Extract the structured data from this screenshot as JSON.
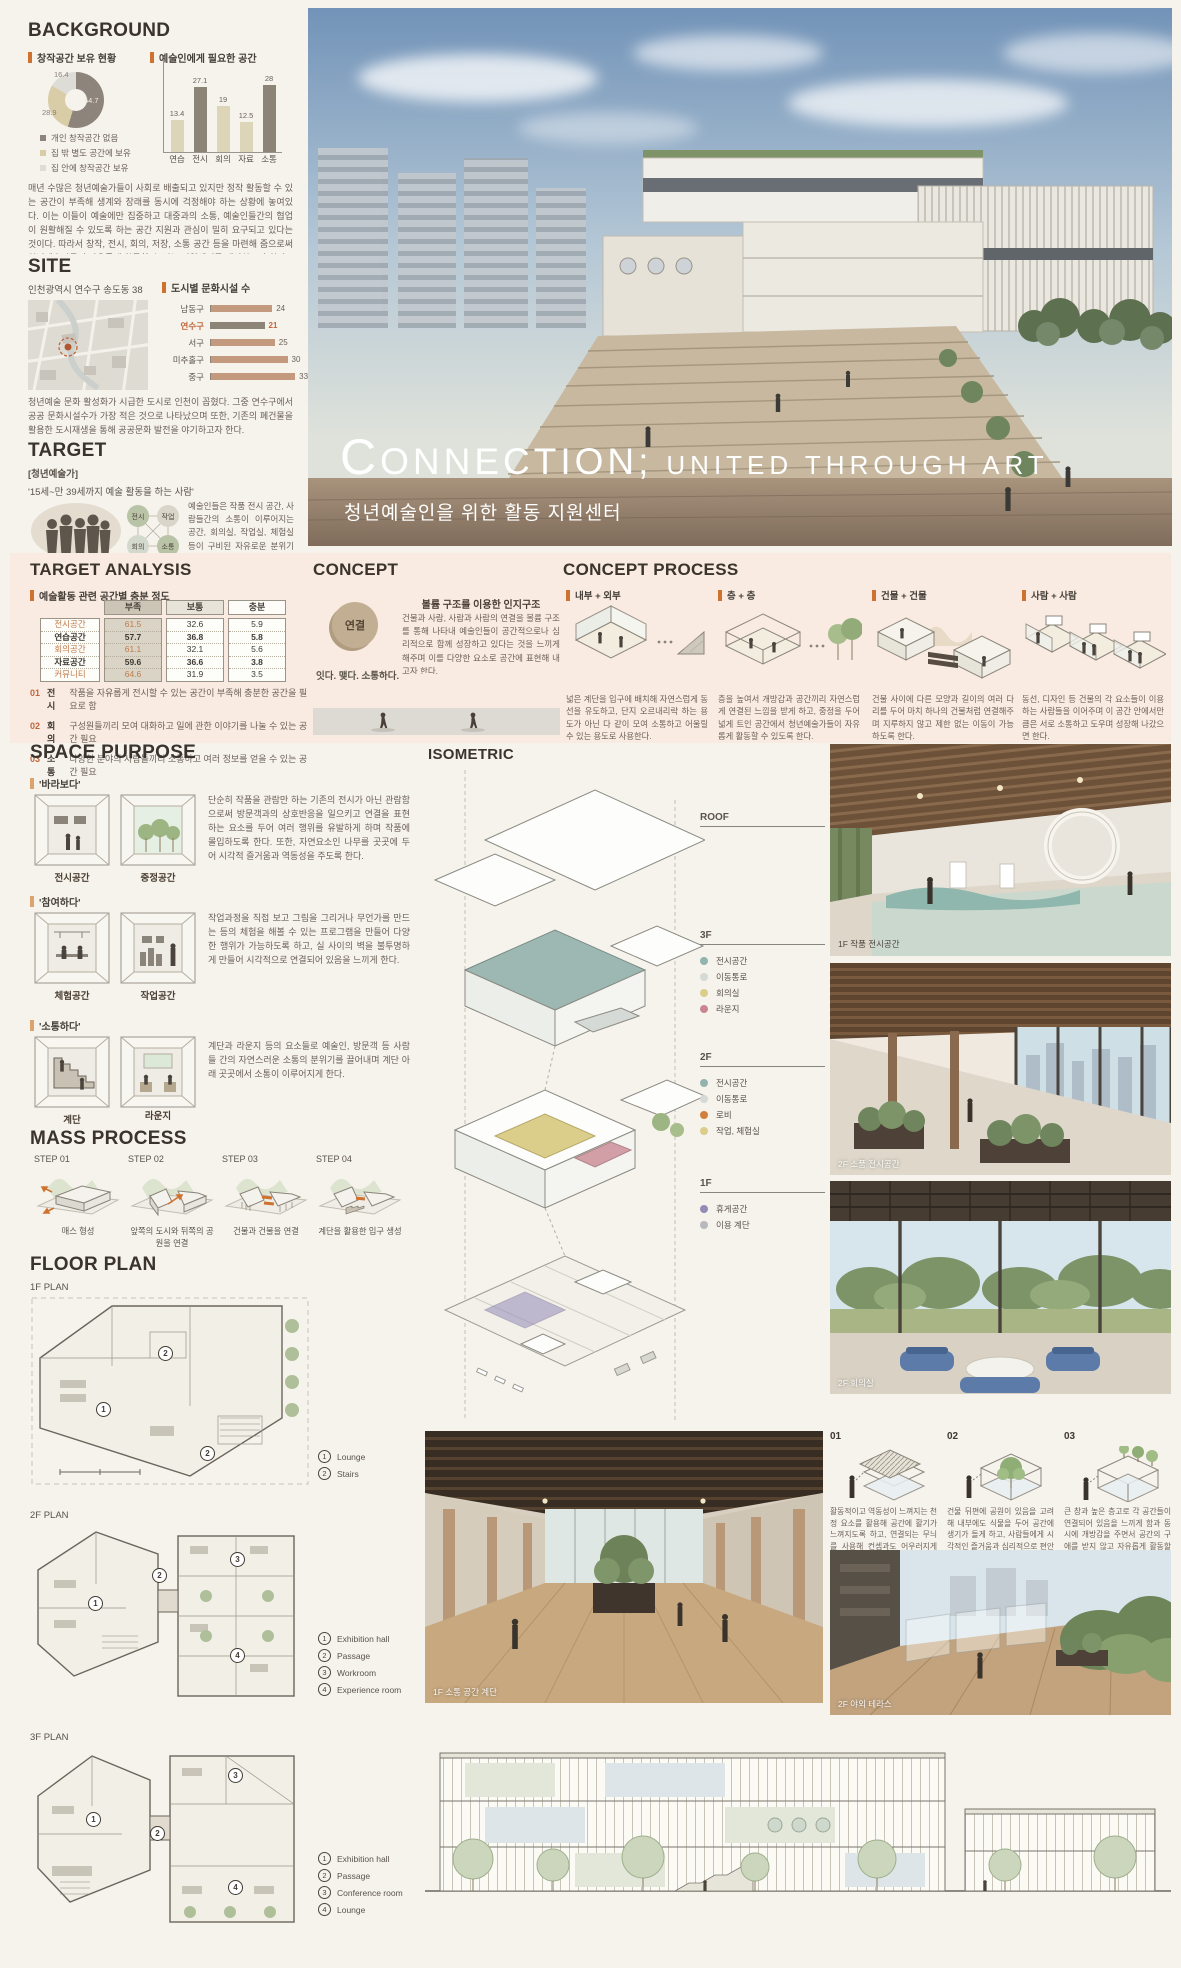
{
  "hero": {
    "title_initial": "C",
    "title_main": "ONNECTION;",
    "title_rest": "UNITED THROUGH ART",
    "subtitle": "청년예술인을 위한 활동 지원센터"
  },
  "background": {
    "heading": "BACKGROUND",
    "pie_label": "창작공간 보유 현황",
    "pie": {
      "type": "pie",
      "values": [
        54.7,
        28.9,
        16.4
      ],
      "labels": [
        "개인 창작공간 없음",
        "집 밖 별도 공간에 보유",
        "집 안에 창작공간 보유"
      ],
      "colors": [
        "#8d857b",
        "#d8cda6",
        "#dddcd7"
      ]
    },
    "bar_label": "예술인에게 필요한 공간",
    "bar": {
      "type": "bar",
      "categories": [
        "연습",
        "전시",
        "회의",
        "자료",
        "소통"
      ],
      "values": [
        13.4,
        27.1,
        19,
        12.5,
        28
      ],
      "colors": [
        "#ddd5b8",
        "#8d8478",
        "#ddd5b8",
        "#ddd5b8",
        "#8d8478"
      ]
    },
    "paragraph": "매년 수많은 청년예술가들이 사회로 배출되고 있지만 정작 활동할 수 있는 공간이 부족해 생계와 장래를 동시에 걱정해야 하는 상황에 놓여있다. 이는 이들이 예술에만 집중하고 대중과의 소통, 예술인들간의 협업이 원활해질 수 있도록 하는 공간 지원과 관심이 밀히 요구되고 있다는 것이다. 따라서 창작, 전시, 회의, 저장, 소통 공간 등을 마련해 줌으로써 청년예술가들이 자유롭게 활동할 수 있는 지원센터를 제안하고자 한다."
  },
  "site": {
    "heading": "SITE",
    "address": "인천광역시 연수구 송도동 38",
    "chart_label": "도시별 문화시설 수",
    "chart": {
      "type": "bar",
      "categories": [
        "남동구",
        "연수구",
        "서구",
        "미추홀구",
        "중구"
      ],
      "values": [
        24,
        21,
        25,
        30,
        33
      ],
      "highlight_index": 1,
      "bar_color": "#c49a7e",
      "highlight_color": "#8d8478"
    },
    "paragraph": "청년예술 문화 활성화가 시급한 도시로 인천이 꼽혔다. 그중 연수구에서 공공 문화시설수가 가장 적은 것으로 나타났으며 또한, 기존의 폐건물을 활용한 도시재생을 통해 공공문화 발전을 야기하고자 한다."
  },
  "target": {
    "heading": "TARGET",
    "group": "[청년예술가]",
    "definition": "'15세~만 39세까지 예술 활동을 하는 사람'",
    "network": [
      "전시",
      "작업",
      "회의",
      "소통"
    ],
    "paragraph": "예술인들은 작품 전시 공간, 사람들간의 소통이 이루어지는 공간, 회의실, 작업실, 체험실 등이 구비된 자유로운 분위기 속에서 활동하기를 희망한다."
  },
  "analysis": {
    "heading": "TARGET ANALYSIS",
    "sub": "예술활동 관련 공간별 충분 정도",
    "columns": [
      "부족",
      "보통",
      "충분"
    ],
    "rows": [
      {
        "label": "전시공간",
        "values": [
          "61.5",
          "32.6",
          "5.9"
        ]
      },
      {
        "label": "연습공간",
        "values": [
          "57.7",
          "36.8",
          "5.8"
        ]
      },
      {
        "label": "회의공간",
        "values": [
          "61.1",
          "32.1",
          "5.6"
        ]
      },
      {
        "label": "자료공간",
        "values": [
          "59.6",
          "36.6",
          "3.8"
        ]
      },
      {
        "label": "커뮤니티",
        "values": [
          "64.6",
          "31.9",
          "3.5"
        ]
      }
    ],
    "notes": [
      {
        "no": "01",
        "tag": "전시",
        "text": "작품을 자유롭게 전시할 수 있는 공간이 부족해 충분한 공간을 필요로 함"
      },
      {
        "no": "02",
        "tag": "회의",
        "text": "구성원들끼리 모여 대화하고 일에 관한 이야기를 나눌 수 있는 공간 필요"
      },
      {
        "no": "03",
        "tag": "소통",
        "text": "다양한 분야의 사람들끼리 소통하고 여러 정보를 얻을 수 있는 공간 필요"
      }
    ]
  },
  "concept": {
    "heading": "CONCEPT",
    "keyword": "연결",
    "tagline": "잇다. 맺다. 소통하다.",
    "subheading": "볼륨 구조를 이용한 인지구조",
    "paragraph": "건물과 사람, 사람과 사람의 연결을 볼륨 구조를 통해 나타내 예술인들이 공간적으로나 심리적으로 함께 성장하고 있다는 것을 느끼게 해주며 이를 다양한 요소로 공간에 표현해 내고자 한다."
  },
  "concept_process": {
    "heading": "CONCEPT PROCESS",
    "items": [
      {
        "label": "내부 + 외부",
        "text": "넓은 계단을 입구에 배치해 자연스럽게 동선을 유도하고, 단지 오르내리락 하는 용도가 아닌 다 같이 모여 소통하고 어울릴 수 있는 용도로 사용한다."
      },
      {
        "label": "층 + 층",
        "text": "층을 높여서 개방감과 공간끼리 자연스럽게 연결된 느낌을 받게 하고, 중정을 두어 넓게 트인 공간에서 청년예술가들이 자유롭게 활동할 수 있도록 한다."
      },
      {
        "label": "건물 + 건물",
        "text": "건물 사이에 다른 모양과 길이의 여러 다리를 두어 마치 하나의 건물처럼 연결해주며 지루하지 않고 제한 없는 이동이 가능하도록 한다."
      },
      {
        "label": "사람 + 사람",
        "text": "동선, 디자인 등 건물의 각 요소들이 이용하는 사람들을 이어주며 이 공간 안에서만큼은 서로 소통하고 도우며 성장해 나갔으면 한다."
      }
    ]
  },
  "space_purpose": {
    "heading": "SPACE PURPOSE",
    "groups": [
      {
        "label": "'바라보다'",
        "rooms": [
          "전시공간",
          "중정공간"
        ],
        "text": "단순히 작품을 관람만 하는 기존의 전시가 아닌 관람함으로써 방문객과의 상호반응을 일으키고 연결을 표현하는 요소를 두어 여러 행위를 유발하게 하며 작품에 몰입하도록 한다. 또한, 자연요소인 나무를 곳곳에 두어 시각적 즐거움과 역동성을 주도록 한다."
      },
      {
        "label": "'참여하다'",
        "rooms": [
          "체험공간",
          "작업공간"
        ],
        "text": "작업과정을 직접 보고 그림을 그리거나 무언가를 만드는 등의 체험을 해볼 수 있는 프로그램을 만들어 다양한 행위가 가능하도록 하고, 실 사이의 벽을 불투명하게 만들어 시각적으로 연결되어 있음을 느끼게 한다."
      },
      {
        "label": "'소통하다'",
        "rooms": [
          "계단",
          "라운지"
        ],
        "text": "계단과 라운지 등의 요소들로 예술인, 방문객 등 사람들 간의 자연스러운 소통의 분위기를 끌어내며 계단 아래 곳곳에서 소통이 이루어지게 한다."
      }
    ]
  },
  "mass_process": {
    "heading": "MASS PROCESS",
    "steps": [
      {
        "step": "STEP 01",
        "caption": "매스 형성"
      },
      {
        "step": "STEP 02",
        "caption": "앞쪽의 도시와 뒤쪽의 공원을 연결"
      },
      {
        "step": "STEP 03",
        "caption": "건물과 건물을 연결"
      },
      {
        "step": "STEP 04",
        "caption": "계단을 활용한 입구 생성"
      }
    ]
  },
  "floor_plan": {
    "heading": "FLOOR PLAN",
    "plans": [
      {
        "label": "1F PLAN",
        "legend": [
          {
            "n": "1",
            "label": "Lounge"
          },
          {
            "n": "2",
            "label": "Stairs"
          }
        ]
      },
      {
        "label": "2F PLAN",
        "legend": [
          {
            "n": "1",
            "label": "Exhibition hall"
          },
          {
            "n": "2",
            "label": "Passage"
          },
          {
            "n": "3",
            "label": "Workroom"
          },
          {
            "n": "4",
            "label": "Experience room"
          }
        ]
      },
      {
        "label": "3F PLAN",
        "legend": [
          {
            "n": "1",
            "label": "Exhibition hall"
          },
          {
            "n": "2",
            "label": "Passage"
          },
          {
            "n": "3",
            "label": "Conference room"
          },
          {
            "n": "4",
            "label": "Lounge"
          }
        ]
      }
    ]
  },
  "isometric": {
    "heading": "ISOMETRIC",
    "floors": [
      {
        "label": "ROOF",
        "items": []
      },
      {
        "label": "3F",
        "items": [
          {
            "label": "전시공간",
            "color": "#93b4ae"
          },
          {
            "label": "이동통로",
            "color": "#d5dad6"
          },
          {
            "label": "회의실",
            "color": "#dbce8a"
          },
          {
            "label": "라운지",
            "color": "#c9858f"
          }
        ]
      },
      {
        "label": "2F",
        "items": [
          {
            "label": "전시공간",
            "color": "#93b4ae"
          },
          {
            "label": "이동통로",
            "color": "#d5dad6"
          },
          {
            "label": "로비",
            "color": "#d0803c"
          },
          {
            "label": "작업, 체험실",
            "color": "#dbce8a"
          }
        ]
      },
      {
        "label": "1F",
        "items": [
          {
            "label": "휴게공간",
            "color": "#928bb8"
          },
          {
            "label": "이용 계단",
            "color": "#b8b9bc"
          }
        ]
      }
    ]
  },
  "gallery": {
    "photos": [
      {
        "caption": "1F 작품 전시공간"
      },
      {
        "caption": "2F 소품 전시공간"
      },
      {
        "caption": "2F 회의실"
      }
    ],
    "main_caption": "1F 소통 공간 계단",
    "terrace_caption": "2F 야외 테라스"
  },
  "insights": {
    "items": [
      {
        "no": "01",
        "text": "활동적이고 역동성이 느껴지는 천정 요소를 활용해 공간에 활기가 느껴지도록 하고, 연결되는 무늬를 사용해 컨셉과도 어우러지게 한다."
      },
      {
        "no": "02",
        "text": "건물 뒤편에 공원이 있음을 고려해 내부에도 식물을 두어 공간에 생기가 돌게 하고, 사람들에게 시각적인 즐거움과 심리적으로 편안함을 준다."
      },
      {
        "no": "03",
        "text": "큰 창과 높은 층고로 각 공간들이 연결되어 있음을 느끼게 함과 동시에 개방감을 주면서 공간의 구애를 받지 않고 자유롭게 활동할 수 있도록 한다."
      }
    ]
  }
}
